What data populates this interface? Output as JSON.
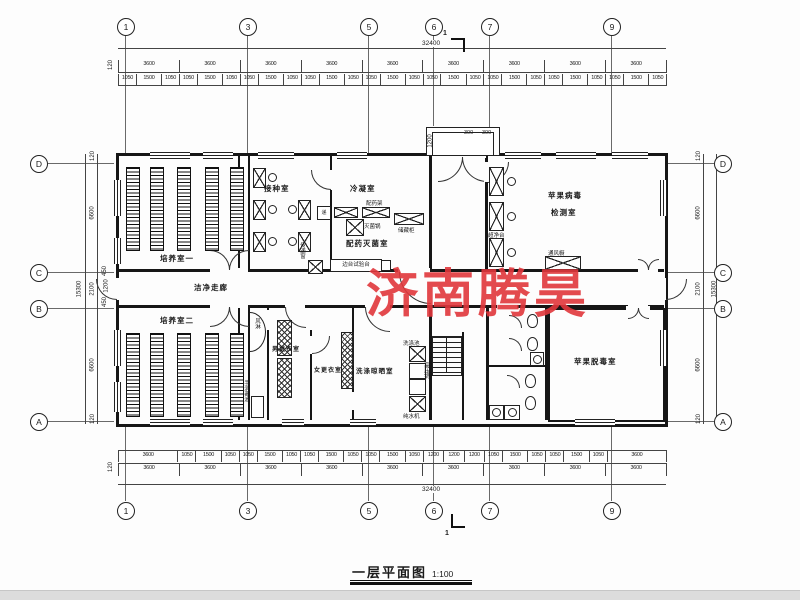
{
  "meta": {
    "title": "一层平面图",
    "scale": "1:100",
    "watermark": "济南腾昊",
    "watermark_color": "#e1373c"
  },
  "grid": {
    "top": [
      "1",
      "3",
      "5",
      "6",
      "7",
      "9"
    ],
    "side": [
      "D",
      "C",
      "B",
      "A"
    ],
    "section_mark": "1"
  },
  "dims": {
    "overall_width": "32400",
    "overall_height": "15300",
    "edge": "120",
    "bay": "3600",
    "bay_count": 9,
    "sub_pattern": [
      "1050",
      "1500",
      "1050"
    ],
    "bottom_sub": [
      "3600",
      "1050",
      "1500",
      "1050",
      "1050",
      "1500",
      "1050",
      "1050",
      "1500",
      "1050",
      "1050",
      "1500",
      "1050",
      "1200",
      "1200",
      "1200",
      "1050",
      "1500",
      "1050",
      "1050",
      "1500",
      "1050",
      "3600"
    ],
    "left_chain": [
      "120",
      "6600",
      "2100",
      "6600",
      "120"
    ],
    "left_cluster": [
      "450",
      "1200",
      "450"
    ],
    "right_chain": [
      "120",
      "6600",
      "2100",
      "6600",
      "120"
    ],
    "entrance": {
      "depth": "1200",
      "step": "300",
      "step2": "300"
    }
  },
  "rooms": {
    "cultivation1": "培养室一",
    "cultivation2": "培养室二",
    "inoculation": "接种室",
    "condensation": "冷凝室",
    "prep_sterilize": "配药灭菌室",
    "clean_corridor": "洁净走廊",
    "virus_test_line1": "苹果病毒",
    "virus_test_line2": "检测室",
    "detox": "苹果脱毒室",
    "men_changing": "男更衣室",
    "women_changing": "女更衣室",
    "washing": "洗涤晾晒室"
  },
  "equipment": {
    "side_bench": "边台试验台",
    "sterilizer": "灭菌锅",
    "storage_cabinet": "储藏柜",
    "medicine_rack": "配药架",
    "clean_bench": "超净台",
    "fume_hood": "通风橱",
    "air_shower": "风淋",
    "pass_window": "传递窗",
    "pass_box": "递",
    "wash_sink": "洗涤池",
    "pressure_pot": "高压锅",
    "pure_water": "纯水机",
    "hand_wash": "手消毒池"
  }
}
